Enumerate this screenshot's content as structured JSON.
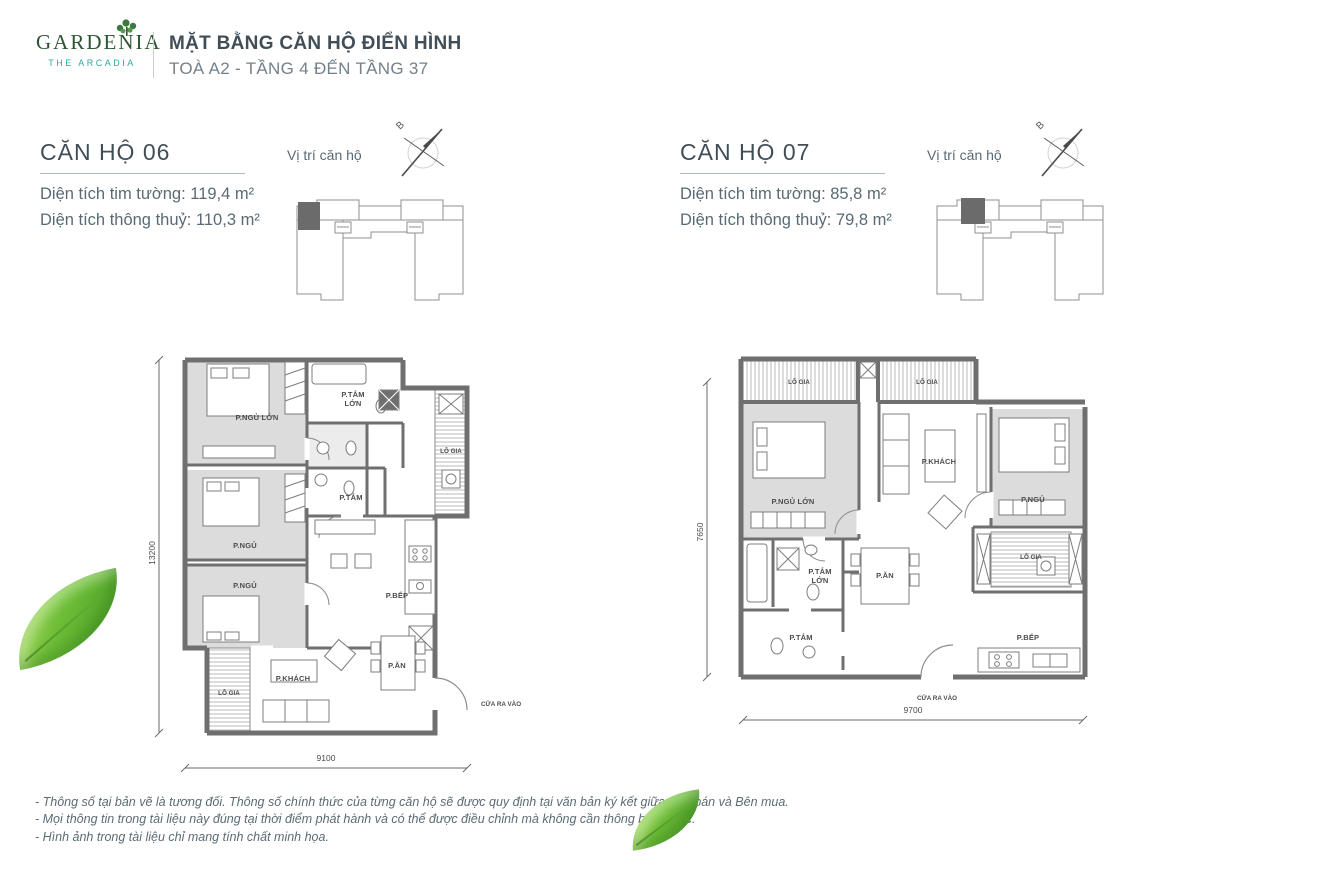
{
  "header": {
    "logo_name": "GARDENIA",
    "logo_tagline": "THE ARCADIA",
    "title": "MẶT BẰNG CĂN HỘ ĐIỂN HÌNH",
    "subtitle": "TOÀ A2 - TẦNG 4 ĐẾN TẦNG 37"
  },
  "location_caption_06": "Vị trí căn hộ",
  "location_caption_07": "Vị trí căn hộ",
  "compass_north": "B",
  "unit06": {
    "title": "CĂN HỘ 06",
    "area1": "Diện tích tim tường: 119,4 m²",
    "area2": "Diện tích thông thuỷ: 110,3 m²",
    "entrance_label": "CỬA RA VÀO",
    "dims": {
      "width": "9100",
      "height": "13200"
    },
    "rooms": {
      "master_bedroom": "P.NGỦ LỚN",
      "master_bath_line1": "P.TẮM",
      "master_bath_line2": "LỚN",
      "balcony_right": "LÔ GIA",
      "bedroom_2": "P.NGỦ",
      "bath": "P.TẮM",
      "bedroom_3": "P.NGỦ",
      "balcony_left": "LÔ GIA",
      "living": "P.KHÁCH",
      "dining": "P.ĂN",
      "kitchen": "P.BẾP"
    }
  },
  "unit07": {
    "title": "CĂN HỘ 07",
    "area1": "Diện tích tim tường: 85,8 m²",
    "area2": "Diện tích thông thuỷ: 79,8 m²",
    "entrance_label": "CỬA RA VÀO",
    "dims": {
      "width": "9700",
      "height": "7650"
    },
    "rooms": {
      "balcony_top_left": "LÔ GIA",
      "balcony_top_right": "LÔ GIA",
      "master_bedroom": "P.NGỦ LỚN",
      "living": "P.KHÁCH",
      "bedroom": "P.NGỦ",
      "master_bath_line1": "P.TẮM",
      "master_bath_line2": "LỚN",
      "dining": "P.ĂN",
      "balcony_right": "LÔ GIA",
      "bath": "P.TẮM",
      "kitchen": "P.BẾP"
    }
  },
  "footnotes": [
    "- Thông số tại bản vẽ là tương đối. Thông số chính thức của từng căn hộ sẽ được quy định tại văn bản ký kết giữa Bên bán và Bên mua.",
    "- Mọi thông tin trong tài liệu này đúng tại thời điểm phát hành và có thể được điều chỉnh mà không cần thông báo trước.",
    "- Hình ảnh trong tài liệu chỉ mang tính chất minh họa."
  ],
  "colors": {
    "brand_green": "#2c5533",
    "brand_teal": "#2da8a2",
    "heading": "#414e58",
    "body_text": "#5a6a74",
    "wall_gray": "#6f6f6f",
    "room_fill": "#dcdcdc",
    "leaf_green": "#6dbd37"
  }
}
